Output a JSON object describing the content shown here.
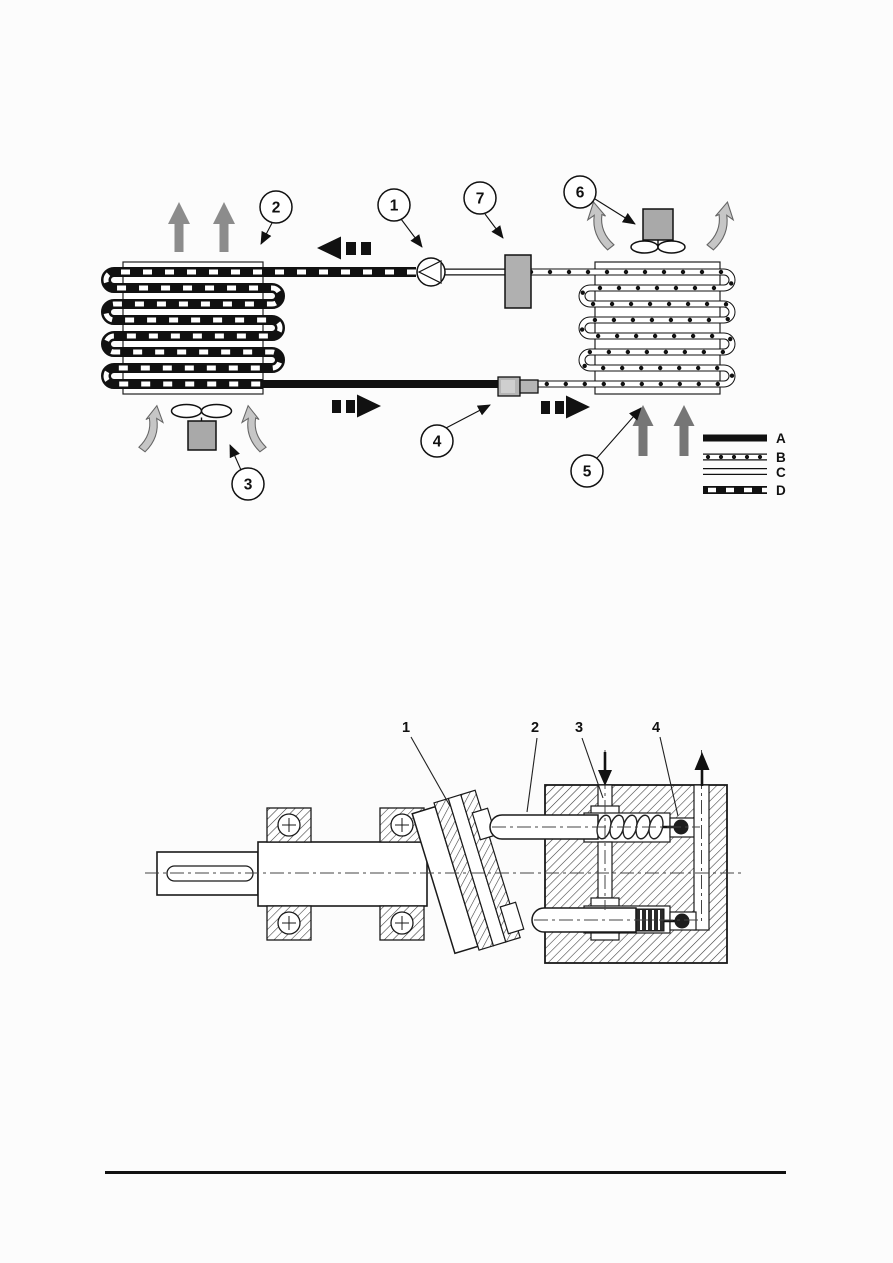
{
  "page": {
    "kind": "scanned-figure-page",
    "background": "#fcfcfc",
    "footer_rule_color": "#111111"
  },
  "fig_top": {
    "name": "refrigeration-circuit-diagram",
    "callouts": [
      {
        "label": "1"
      },
      {
        "label": "2"
      },
      {
        "label": "3"
      },
      {
        "label": "4"
      },
      {
        "label": "5"
      },
      {
        "label": "6"
      },
      {
        "label": "7"
      }
    ],
    "legend": {
      "items": [
        {
          "label": "A",
          "style": "thick-solid-line"
        },
        {
          "label": "B",
          "style": "tube-with-dots"
        },
        {
          "label": "C",
          "style": "empty-tube"
        },
        {
          "label": "D",
          "style": "thick-line-with-white-dashes"
        }
      ]
    },
    "colors": {
      "ink": "#151515",
      "component_gray": "#aaaaaa",
      "arrow_gray": "#8c8c8c",
      "arrow_dark_gray": "#757575",
      "arrow_light_gray": "#c6c6c6"
    }
  },
  "fig_bottom": {
    "name": "axial-piston-pump-cross-section",
    "callouts": [
      {
        "label": "1"
      },
      {
        "label": "2"
      },
      {
        "label": "3"
      },
      {
        "label": "4"
      }
    ]
  }
}
